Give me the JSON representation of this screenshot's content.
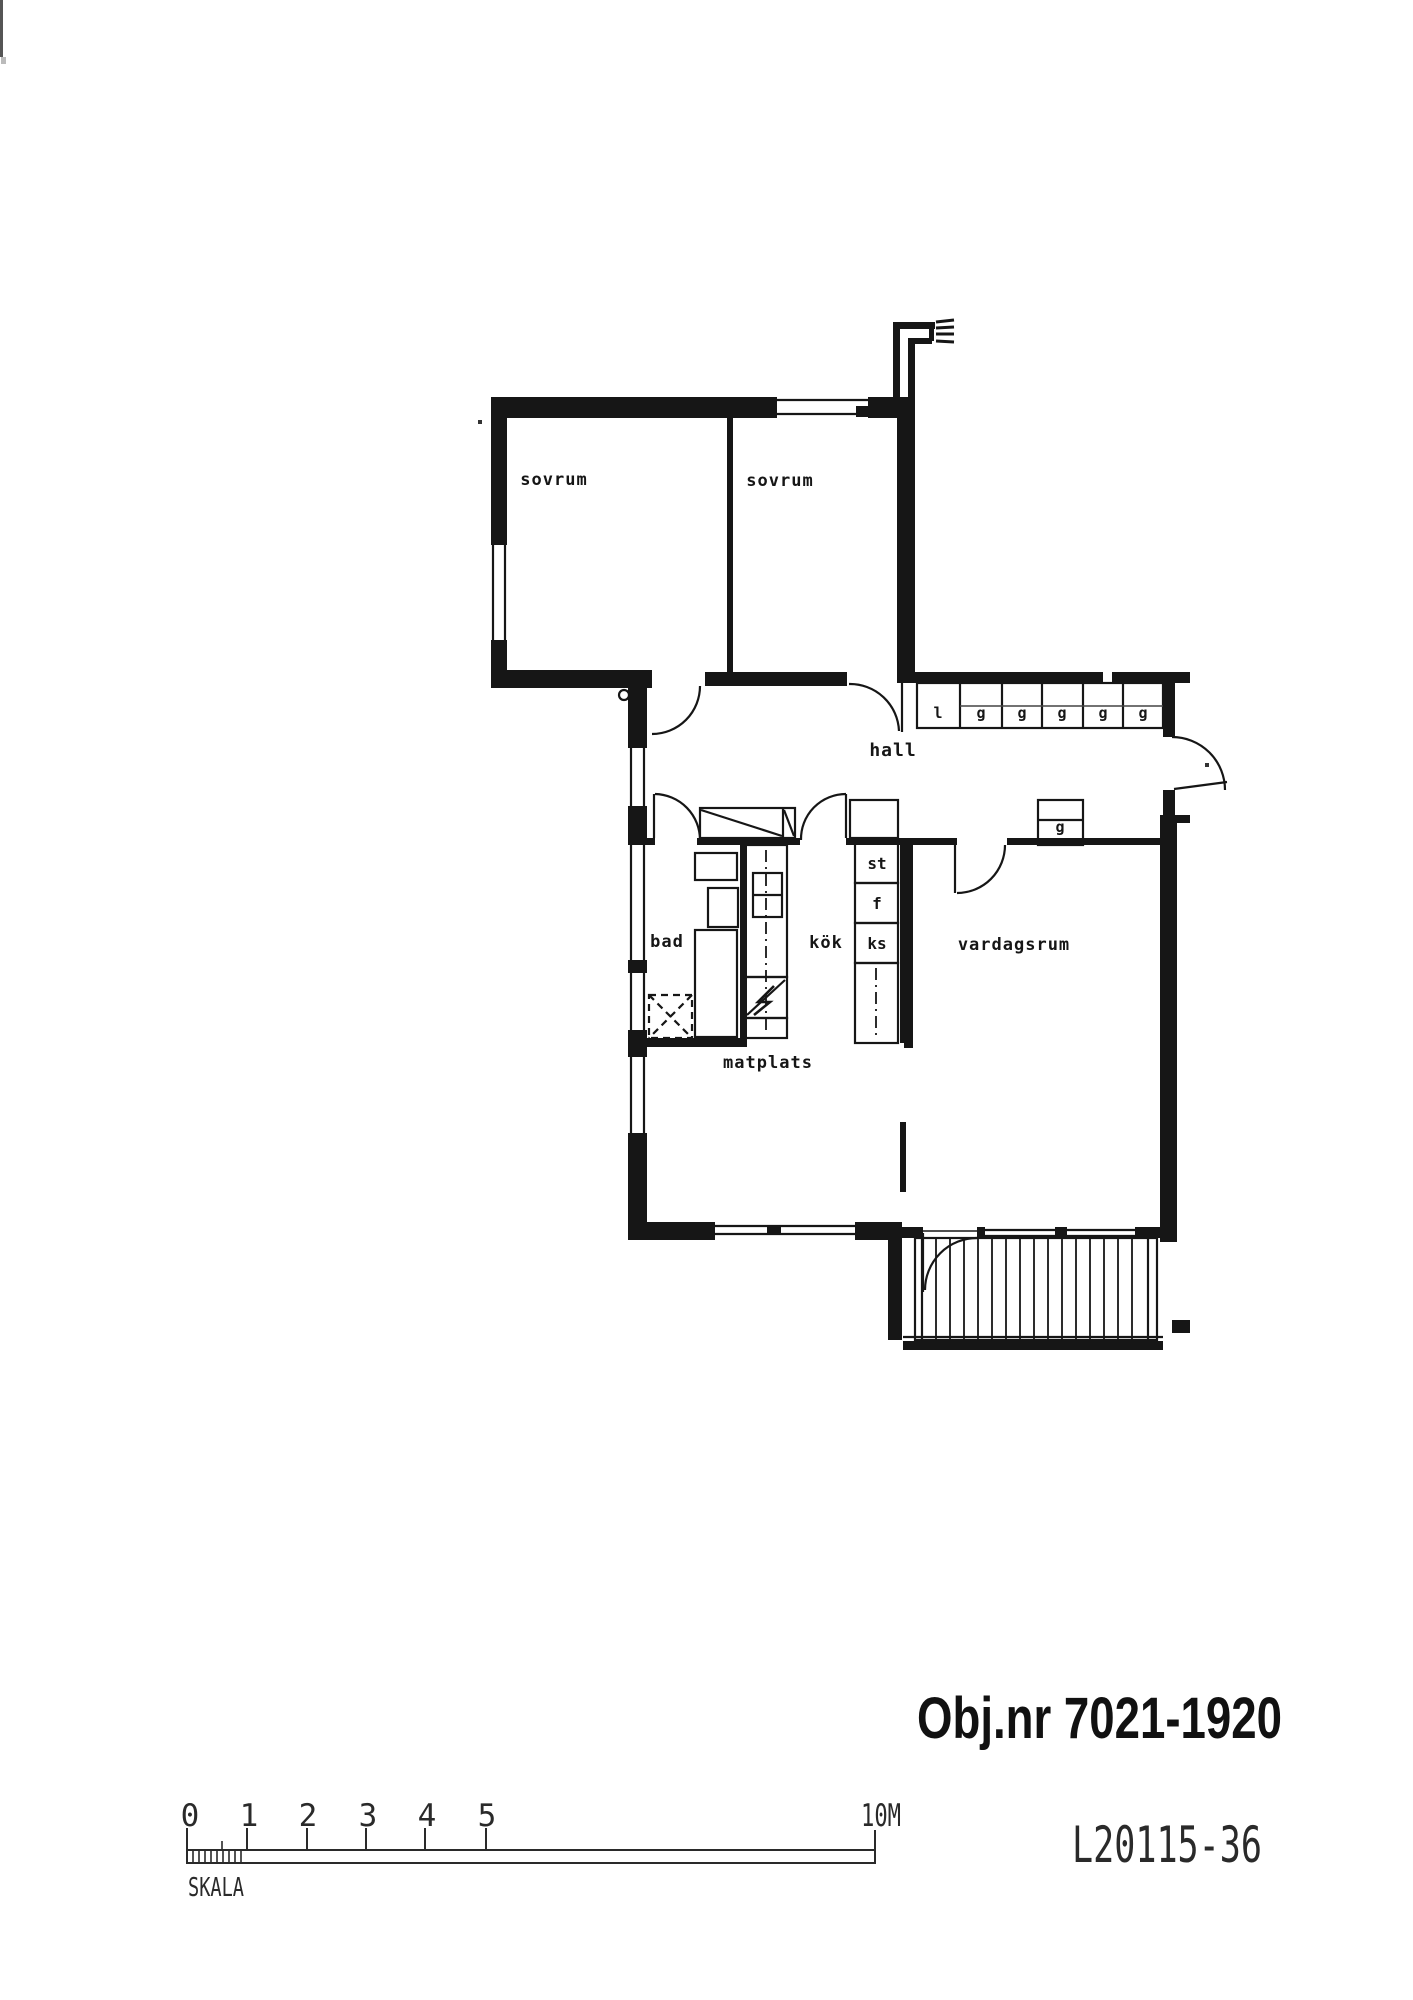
{
  "colors": {
    "ink": "#161616",
    "paper": "#ffffff"
  },
  "plan": {
    "rooms": [
      {
        "id": "sovrum-left",
        "label": "sovrum"
      },
      {
        "id": "sovrum-right",
        "label": "sovrum"
      },
      {
        "id": "hall",
        "label": "hall"
      },
      {
        "id": "bad",
        "label": "bad"
      },
      {
        "id": "kok",
        "label": "kök"
      },
      {
        "id": "vardagsrum",
        "label": "vardagsrum"
      },
      {
        "id": "matplats",
        "label": "matplats"
      }
    ],
    "wardrobes": {
      "linen": "l",
      "g": "g"
    },
    "appliances": {
      "st": "st",
      "f": "f",
      "ks": "ks"
    }
  },
  "titles": {
    "object_number": "Obj.nr 7021-1920",
    "drawing_number": "L20115-36"
  },
  "scale_bar": {
    "label": "SKALA",
    "ticks": [
      "0",
      "1",
      "2",
      "3",
      "4",
      "5"
    ],
    "end": "10M"
  }
}
